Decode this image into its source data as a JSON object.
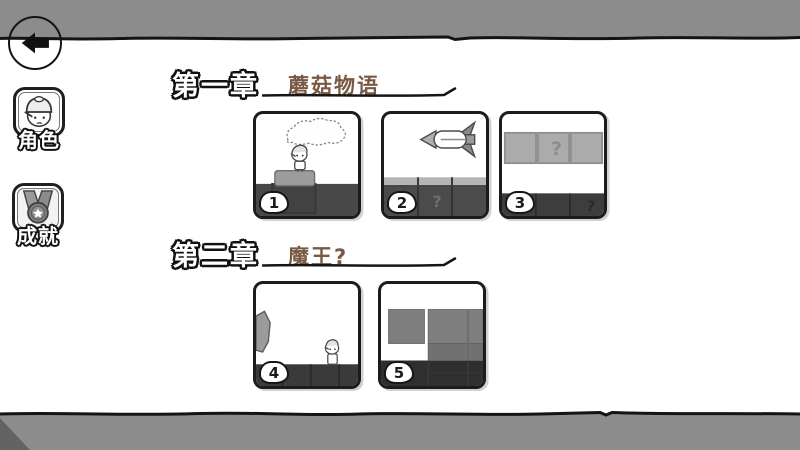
{
  "colors": {
    "bar_gray": "#8c8c8c",
    "outline_black": "#141414",
    "chapter_title_brown": "#7a5944",
    "ground_dark": "#474747",
    "block_light_gray": "#ababab",
    "block_mid_gray": "#7e7e7e"
  },
  "sidebar": {
    "buttons": [
      {
        "id": "character",
        "label": "角色"
      },
      {
        "id": "achievements",
        "label": "成就"
      }
    ]
  },
  "chapters": [
    {
      "heading": "第一章",
      "title": "蘑菇物语",
      "levels": [
        {
          "number": "1"
        },
        {
          "number": "2",
          "block_texts": {
            "left": "顶我",
            "middle": "?"
          }
        },
        {
          "number": "3",
          "block_texts": {
            "middle": "?",
            "ground_right": "?"
          }
        }
      ]
    },
    {
      "heading": "第二章",
      "title": "魔王?",
      "levels": [
        {
          "number": "4"
        },
        {
          "number": "5"
        }
      ]
    }
  ]
}
